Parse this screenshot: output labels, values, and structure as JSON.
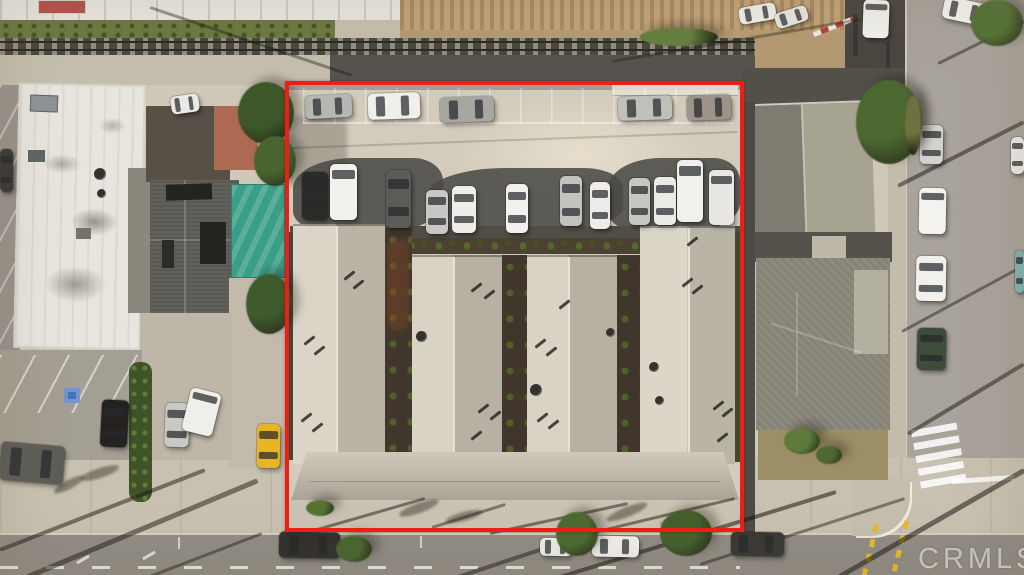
{
  "scene": {
    "type": "aerial-photo",
    "description": "Drone aerial view of a multifamily property outlined in red: rear parking lot with two rows of cars, four long gabled apartment roofs, neighboring white commercial roof and houses, rail corridor on top, streets bottom and right",
    "watermark": "CRMLS",
    "outline_color": "#ee1d15",
    "palette": {
      "concrete": "#d3cbbb",
      "sidewalk": "#c8c1b1",
      "asphalt": "#908c84",
      "dark_asphalt": "#56544e",
      "roof_light": "#dad5c7",
      "roof_dark": "#b9b4a5",
      "white_roof": "#e8e5de",
      "dark_roof": "#5a5852",
      "teal_canopy": "#3b9e87",
      "grass": "#6d7942",
      "dirt": "#c0a379",
      "tree": "#49622f",
      "rail": "#49483f",
      "yellow_marking": "#e3ba2d",
      "handicap_blue": "#4273bd",
      "yellow_car": "#e8b622"
    },
    "cars": [
      {
        "x": 305,
        "y": 95,
        "w": 47,
        "h": 23,
        "r": -3,
        "c": "#b7b6b2"
      },
      {
        "x": 368,
        "y": 93,
        "w": 52,
        "h": 26,
        "r": -2,
        "c": "#f0efeb"
      },
      {
        "x": 440,
        "y": 97,
        "w": 54,
        "h": 25,
        "r": -2,
        "c": "#a7a6a1"
      },
      {
        "x": 618,
        "y": 96,
        "w": 54,
        "h": 24,
        "r": -2,
        "c": "#c0bfba"
      },
      {
        "x": 687,
        "y": 95,
        "w": 44,
        "h": 25,
        "r": -2,
        "c": "#9c9488"
      },
      {
        "x": 302,
        "y": 172,
        "w": 26,
        "h": 48,
        "r": 0,
        "c": "#2c2b29"
      },
      {
        "x": 330,
        "y": 164,
        "w": 27,
        "h": 56,
        "r": 0,
        "c": "#f2f1ed",
        "k": "van"
      },
      {
        "x": 386,
        "y": 170,
        "w": 25,
        "h": 58,
        "r": 0,
        "c": "#5c5b57"
      },
      {
        "x": 426,
        "y": 190,
        "w": 22,
        "h": 44,
        "r": 0,
        "c": "#c8c7c3"
      },
      {
        "x": 452,
        "y": 186,
        "w": 24,
        "h": 47,
        "r": 0,
        "c": "#eeede9"
      },
      {
        "x": 506,
        "y": 184,
        "w": 22,
        "h": 49,
        "r": 0,
        "c": "#f2f1ee"
      },
      {
        "x": 560,
        "y": 176,
        "w": 22,
        "h": 50,
        "r": 0,
        "c": "#c3c2be"
      },
      {
        "x": 590,
        "y": 182,
        "w": 20,
        "h": 47,
        "r": 0,
        "c": "#edece8"
      },
      {
        "x": 629,
        "y": 178,
        "w": 21,
        "h": 47,
        "r": 0,
        "c": "#c7c6c2"
      },
      {
        "x": 654,
        "y": 177,
        "w": 22,
        "h": 48,
        "r": 0,
        "c": "#eceae6"
      },
      {
        "x": 677,
        "y": 160,
        "w": 26,
        "h": 62,
        "r": 0,
        "c": "#f1f0ec",
        "k": "van"
      },
      {
        "x": 709,
        "y": 170,
        "w": 25,
        "h": 55,
        "r": 0,
        "c": "#e8e7e3",
        "k": "van"
      },
      {
        "x": 0,
        "y": 444,
        "w": 64,
        "h": 38,
        "r": 5,
        "c": "#5e5d58"
      },
      {
        "x": 101,
        "y": 400,
        "w": 27,
        "h": 47,
        "r": 3,
        "c": "#232220"
      },
      {
        "x": 165,
        "y": 403,
        "w": 24,
        "h": 44,
        "r": 2,
        "c": "#cac9c5"
      },
      {
        "x": 186,
        "y": 390,
        "w": 31,
        "h": 44,
        "r": 14,
        "c": "#efeeea",
        "k": "van"
      },
      {
        "x": 257,
        "y": 424,
        "w": 23,
        "h": 44,
        "r": 1,
        "c": "#e8b622"
      },
      {
        "x": 171,
        "y": 95,
        "w": 28,
        "h": 18,
        "r": -8,
        "c": "#eae9e5"
      },
      {
        "x": 0,
        "y": 149,
        "w": 13,
        "h": 43,
        "r": 0,
        "c": "#3b3a37"
      },
      {
        "x": 739,
        "y": 5,
        "w": 37,
        "h": 17,
        "r": -10,
        "c": "#efeeea"
      },
      {
        "x": 775,
        "y": 9,
        "w": 33,
        "h": 16,
        "r": -18,
        "c": "#e7e6e1"
      },
      {
        "x": 863,
        "y": 0,
        "w": 26,
        "h": 38,
        "r": 2,
        "c": "#f2f1ed",
        "k": "van"
      },
      {
        "x": 943,
        "y": 0,
        "w": 43,
        "h": 22,
        "r": 12,
        "c": "#f4f3ef"
      },
      {
        "x": 920,
        "y": 125,
        "w": 23,
        "h": 39,
        "r": 1,
        "c": "#d3d2ce"
      },
      {
        "x": 919,
        "y": 188,
        "w": 27,
        "h": 46,
        "r": 1,
        "c": "#f3f2ee",
        "k": "van"
      },
      {
        "x": 916,
        "y": 256,
        "w": 30,
        "h": 45,
        "r": 1,
        "c": "#f1f0ec"
      },
      {
        "x": 917,
        "y": 328,
        "w": 29,
        "h": 42,
        "r": 1,
        "c": "#3e4c3c"
      },
      {
        "x": 1011,
        "y": 137,
        "w": 13,
        "h": 37,
        "r": 0,
        "c": "#e9e8e4"
      },
      {
        "x": 1015,
        "y": 250,
        "w": 9,
        "h": 43,
        "r": 0,
        "c": "#7fb2ad"
      },
      {
        "x": 279,
        "y": 532,
        "w": 61,
        "h": 26,
        "r": 1,
        "c": "#32312e"
      },
      {
        "x": 540,
        "y": 538,
        "w": 32,
        "h": 18,
        "r": 1,
        "c": "#ecebe7"
      },
      {
        "x": 592,
        "y": 536,
        "w": 47,
        "h": 21,
        "r": 1,
        "c": "#efeeea"
      },
      {
        "x": 731,
        "y": 532,
        "w": 53,
        "h": 24,
        "r": 1,
        "c": "#3a3936"
      }
    ],
    "trees": [
      {
        "x": 238,
        "y": 82,
        "w": 56,
        "h": 62,
        "c": "#3d5729"
      },
      {
        "x": 254,
        "y": 136,
        "w": 42,
        "h": 50,
        "c": "#49642f"
      },
      {
        "x": 246,
        "y": 274,
        "w": 46,
        "h": 60,
        "c": "#3f5a2b"
      },
      {
        "x": 336,
        "y": 536,
        "w": 36,
        "h": 26,
        "c": "#4a6530"
      },
      {
        "x": 556,
        "y": 512,
        "w": 42,
        "h": 44,
        "c": "#4d6a32"
      },
      {
        "x": 660,
        "y": 510,
        "w": 52,
        "h": 46,
        "c": "#45602d"
      },
      {
        "x": 856,
        "y": 80,
        "w": 66,
        "h": 84,
        "c": "#4c6831"
      },
      {
        "x": 971,
        "y": 0,
        "w": 52,
        "h": 46,
        "c": "#567237"
      },
      {
        "x": 640,
        "y": 28,
        "w": 78,
        "h": 18,
        "c": "#64803f"
      },
      {
        "x": 784,
        "y": 428,
        "w": 36,
        "h": 26,
        "c": "#5d7a3a"
      },
      {
        "x": 816,
        "y": 446,
        "w": 26,
        "h": 18,
        "c": "#4f6830"
      },
      {
        "x": 905,
        "y": 95,
        "w": 16,
        "h": 60,
        "c": "#6f7040"
      },
      {
        "x": 306,
        "y": 500,
        "w": 28,
        "h": 16,
        "c": "#55742f"
      }
    ],
    "roof_vents": [
      {
        "x": 303,
        "y": 339
      },
      {
        "x": 313,
        "y": 349
      },
      {
        "x": 300,
        "y": 416
      },
      {
        "x": 311,
        "y": 426
      },
      {
        "x": 343,
        "y": 274
      },
      {
        "x": 352,
        "y": 283
      },
      {
        "x": 470,
        "y": 286
      },
      {
        "x": 483,
        "y": 293
      },
      {
        "x": 477,
        "y": 407
      },
      {
        "x": 489,
        "y": 414
      },
      {
        "x": 470,
        "y": 434
      },
      {
        "x": 534,
        "y": 342
      },
      {
        "x": 545,
        "y": 350
      },
      {
        "x": 536,
        "y": 416
      },
      {
        "x": 547,
        "y": 423
      },
      {
        "x": 558,
        "y": 303
      },
      {
        "x": 681,
        "y": 281
      },
      {
        "x": 691,
        "y": 288
      },
      {
        "x": 712,
        "y": 404
      },
      {
        "x": 721,
        "y": 411
      },
      {
        "x": 716,
        "y": 436
      },
      {
        "x": 686,
        "y": 240
      }
    ],
    "dishes": [
      {
        "x": 416,
        "y": 331,
        "d": 11
      },
      {
        "x": 530,
        "y": 384,
        "d": 12
      },
      {
        "x": 606,
        "y": 328,
        "d": 9
      },
      {
        "x": 649,
        "y": 362,
        "d": 10
      },
      {
        "x": 655,
        "y": 396,
        "d": 9
      },
      {
        "x": 94,
        "y": 168,
        "d": 12
      },
      {
        "x": 97,
        "y": 189,
        "d": 9
      }
    ],
    "fronds": [
      {
        "x": 398,
        "y": 503,
        "w": 42,
        "h": 10,
        "r": -20
      },
      {
        "x": 445,
        "y": 512,
        "w": 38,
        "h": 9,
        "r": -15
      },
      {
        "x": 605,
        "y": 507,
        "w": 44,
        "h": 10,
        "r": -22
      },
      {
        "x": 660,
        "y": 516,
        "w": 36,
        "h": 9,
        "r": -12
      },
      {
        "x": 80,
        "y": 468,
        "w": 40,
        "h": 10,
        "r": -18
      },
      {
        "x": 52,
        "y": 480,
        "w": 34,
        "h": 9,
        "r": -28
      }
    ],
    "shadow_lines": [
      {
        "x1": 0,
        "y1": 548,
        "x2": 205,
        "y2": 468,
        "w": 4,
        "o": 0.5
      },
      {
        "x1": 26,
        "y1": 575,
        "x2": 258,
        "y2": 478,
        "w": 5,
        "o": 0.5
      },
      {
        "x1": 150,
        "y1": 575,
        "x2": 262,
        "y2": 532,
        "w": 3,
        "o": 0.45
      },
      {
        "x1": 300,
        "y1": 533,
        "x2": 425,
        "y2": 497,
        "w": 3,
        "o": 0.5
      },
      {
        "x1": 432,
        "y1": 526,
        "x2": 505,
        "y2": 503,
        "w": 3,
        "o": 0.45
      },
      {
        "x1": 458,
        "y1": 575,
        "x2": 588,
        "y2": 532,
        "w": 4,
        "o": 0.5
      },
      {
        "x1": 490,
        "y1": 532,
        "x2": 628,
        "y2": 502,
        "w": 3,
        "o": 0.5
      },
      {
        "x1": 585,
        "y1": 533,
        "x2": 735,
        "y2": 497,
        "w": 3,
        "o": 0.5
      },
      {
        "x1": 560,
        "y1": 575,
        "x2": 836,
        "y2": 490,
        "w": 4,
        "o": 0.55
      },
      {
        "x1": 700,
        "y1": 563,
        "x2": 905,
        "y2": 497,
        "w": 3,
        "o": 0.45
      },
      {
        "x1": 838,
        "y1": 575,
        "x2": 1024,
        "y2": 468,
        "w": 5,
        "o": 0.55
      },
      {
        "x1": 908,
        "y1": 432,
        "x2": 1024,
        "y2": 362,
        "w": 4,
        "o": 0.5
      },
      {
        "x1": 902,
        "y1": 330,
        "x2": 1024,
        "y2": 264,
        "w": 3,
        "o": 0.45
      },
      {
        "x1": 898,
        "y1": 184,
        "x2": 1024,
        "y2": 120,
        "w": 4,
        "o": 0.5
      },
      {
        "x1": 938,
        "y1": 62,
        "x2": 1024,
        "y2": 20,
        "w": 3,
        "o": 0.45
      },
      {
        "x1": 150,
        "y1": 6,
        "x2": 352,
        "y2": 74,
        "w": 3,
        "o": 0.4
      },
      {
        "x1": 290,
        "y1": 147,
        "x2": 738,
        "y2": 131,
        "w": 2,
        "o": 0.18
      },
      {
        "x1": 612,
        "y1": 60,
        "x2": 860,
        "y2": 18,
        "w": 3,
        "o": 0.35
      }
    ]
  }
}
